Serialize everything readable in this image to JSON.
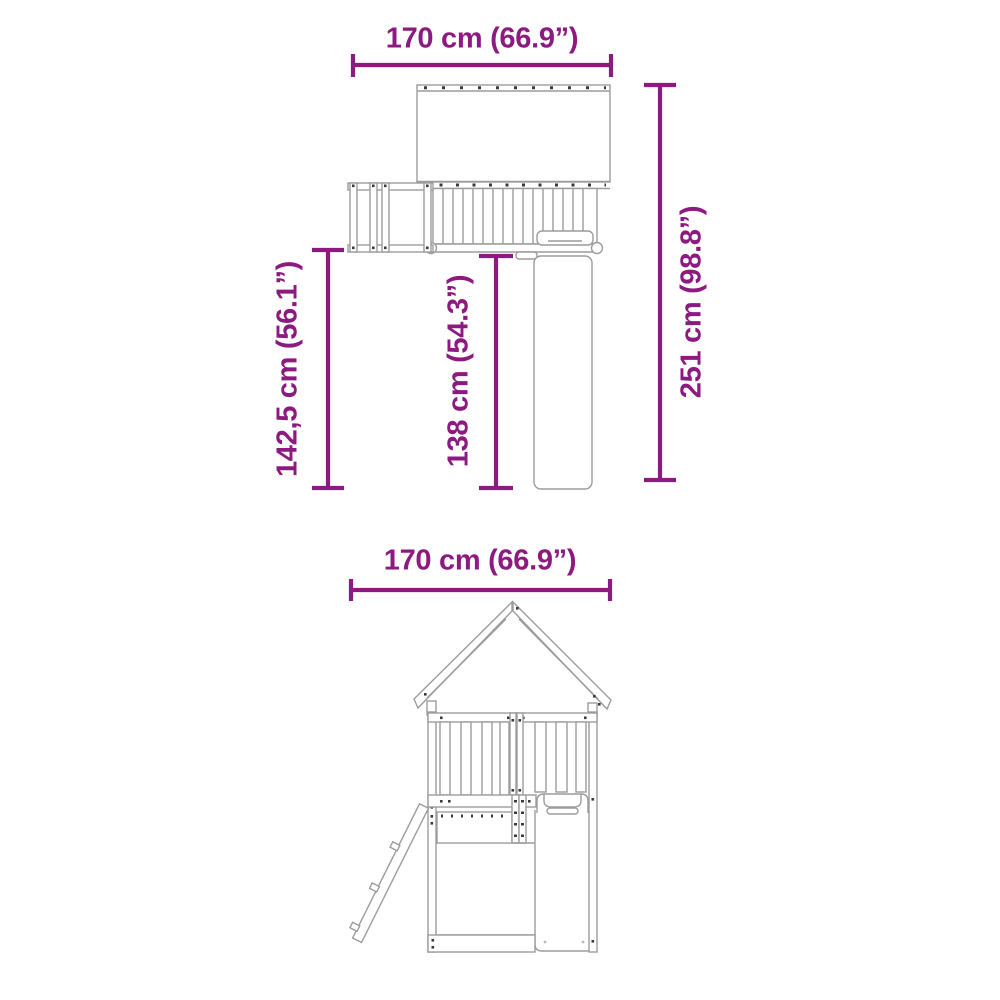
{
  "page": {
    "background": "#ffffff",
    "content_type": "product dimension diagram"
  },
  "colors": {
    "dimension_accent": "#8C1A80",
    "line_art": "#9C9C9C",
    "bolt_marks": "#3A3A3A"
  },
  "top_view": {
    "width_label": "170 cm (66.9”)",
    "overall_height_label": "251 cm (98.8”)",
    "platform_depth_label": "142,5 cm (56.1”)",
    "slide_depth_label": "138 cm (54.3”)"
  },
  "front_view": {
    "width_label": "170 cm (66.9”)"
  }
}
